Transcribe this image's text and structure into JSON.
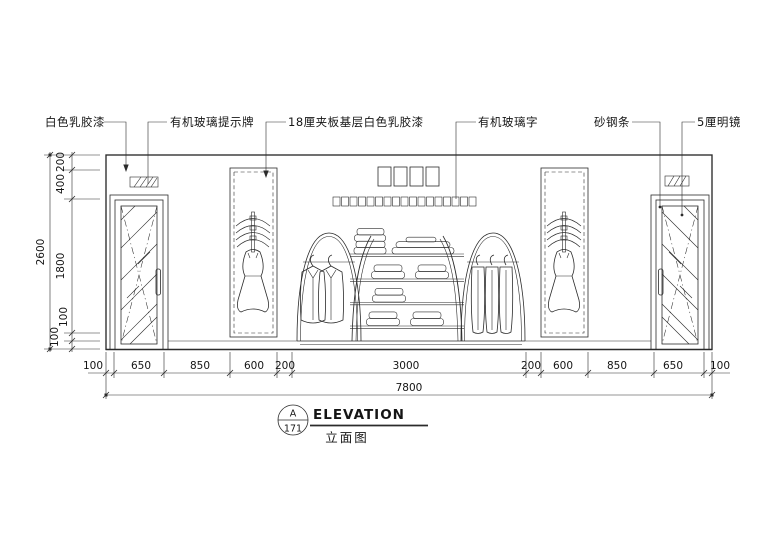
{
  "drawing": {
    "callouts": {
      "white_latex_paint": "白色乳胶漆",
      "acrylic_sign_board": "有机玻璃提示牌",
      "plywood_base_white_latex": "18厘夹板基层白色乳胶漆",
      "acrylic_letters": "有机玻璃字",
      "sanded_steel_strip": "砂钢条",
      "clear_mirror_5mm": "5厘明镜"
    },
    "signage": {
      "large_character_count": 4,
      "small_character_count": 17
    }
  },
  "dimensions": {
    "bottom": {
      "segments": [
        "100",
        "650",
        "850",
        "600",
        "200",
        "3000",
        "200",
        "600",
        "850",
        "650",
        "100"
      ],
      "total": "7800"
    },
    "left": {
      "segments": [
        "200",
        "400",
        "1800",
        "100",
        "100"
      ],
      "total": "2600"
    }
  },
  "title_block": {
    "detail_letter": "A",
    "sheet_number": "171",
    "title_en": "ELEVATION",
    "title_zh": "立面图"
  },
  "colors": {
    "line_color": "#2b2b2b",
    "background": "#ffffff"
  }
}
